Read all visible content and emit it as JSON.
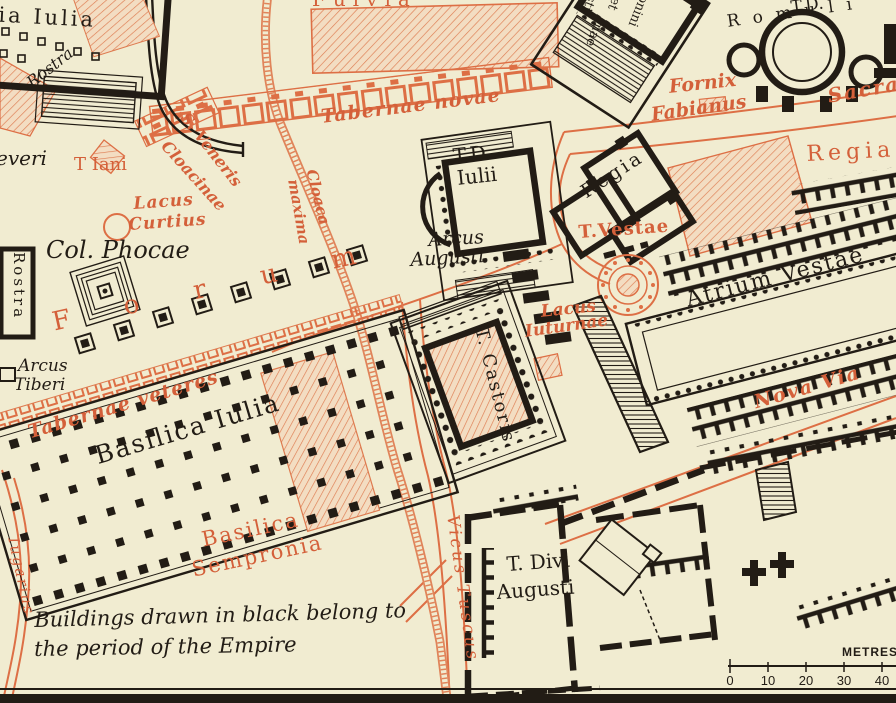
{
  "map_title": "Roman Forum plan (Empire period)",
  "colors": {
    "paper": "#f1ecd1",
    "ink": "#221c15",
    "orange": "#d4603a",
    "hatch": "#de7b50"
  },
  "labels": {
    "curia_iulia": "ria Iulia",
    "rostra_nw": "Rostra",
    "fulvia": "Fulvia",
    "tabernae_novae": "Tabernae novae",
    "s_veneris": "S. Veneris",
    "cloacinae": "Cloacinae",
    "cloaca": "Cloaca",
    "maxima": "maxima",
    "t_iani": "T Iani",
    "severi_fragment": "everi",
    "lacus": "Lacus",
    "curtius": "Curtius",
    "col_phocae": "Col. Phocae",
    "forum": "Forum",
    "rostra_w": "Rostra",
    "arcus_t": "Arcus",
    "tiberi": "Tiberi",
    "tabernae_veteres": "Tabernae veteres",
    "basilica_iulia": "Basilica Iulia",
    "basilica_sempronia_1": "Basilica",
    "basilica_sempronia_2": "Sempronia",
    "iugarius": "Iugarius",
    "vicus_tuscus": "Vicus Tuscus",
    "note_line1": "Buildings drawn in black belong to",
    "note_line2": "the period of the Empire",
    "arcus_augusti_1": "Arcus",
    "arcus_augusti_2": "Augusti",
    "td_iulii_1": "T.D.",
    "td_iulii_2": "Iulii",
    "regia_black": "Regia",
    "regia_orange": "Regia",
    "fornix": "Fornix",
    "fabianus": "Fabianus",
    "sacra": "Sacra",
    "td_romuli_1": "T.D.",
    "td_romuli_2": "Romuli",
    "faustina_frag_sti": "sti",
    "faustina_frag_nae": "nae",
    "faustina_frag_et": "et",
    "faustina_frag_onini": "onini",
    "t_vestae": "T.Vestae",
    "atrium_vestae": "Atrium Vestae",
    "lacus_iuturnae_1": "Lacus",
    "lacus_iuturnae_2": "Iuturnae",
    "t_castoris": "T. Castoris",
    "nova_via": "Nova Via",
    "t_divi_1": "T. Divi",
    "t_divi_2": "Augusti"
  },
  "scale": {
    "unit_label": "METRES",
    "ticks": [
      "0",
      "10",
      "20",
      "30",
      "40"
    ]
  }
}
